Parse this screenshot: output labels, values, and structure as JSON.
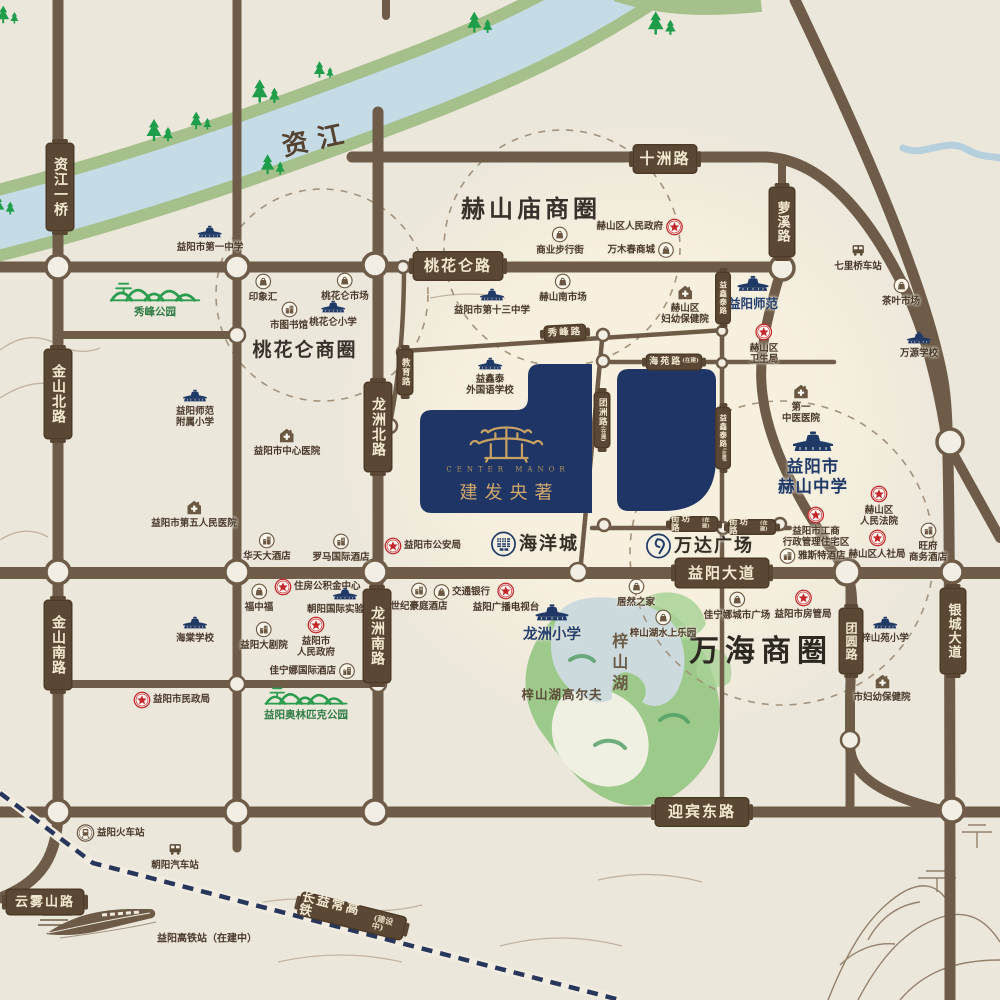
{
  "map": {
    "river_name": "资江",
    "project": {
      "name_cn": "建发央著",
      "name_en": "CENTER MANOR",
      "seal_char": "建"
    },
    "colors": {
      "paper": "#ece7db",
      "road": "#6e5c49",
      "plaque": "#5b4834",
      "navy": "#203a68",
      "gold": "#c9a264",
      "red": "#c3272b",
      "green": "#2a9d4e",
      "bank": "#a6c08c",
      "water": "#c5dbe6",
      "lake": "#ccdadd"
    },
    "business_circles": [
      {
        "id": "taohualun-circle",
        "x": 322,
        "y": 295,
        "r": 106
      },
      {
        "id": "heshanmiao-circle",
        "x": 562,
        "y": 248,
        "r": 118
      },
      {
        "id": "wanhai-circle",
        "x": 782,
        "y": 553,
        "r": 152
      }
    ],
    "free_texts": [
      {
        "id": "zijiang-river-name",
        "text": "资江",
        "x": 318,
        "y": 141,
        "size": 26,
        "color": "#54412f",
        "rot": -12,
        "ls": 10
      },
      {
        "id": "heshanmiao-circle-name",
        "text": "赫山庙商圈",
        "x": 531,
        "y": 209,
        "size": 24,
        "color": "#38302a",
        "ls": 4
      },
      {
        "id": "taohualun-circle-name",
        "text": "桃花仑商圈",
        "x": 305,
        "y": 351,
        "size": 19,
        "color": "#38302a",
        "ls": 2
      },
      {
        "id": "wanhai-circle-name",
        "text": "万海商圈",
        "x": 761,
        "y": 652,
        "size": 30,
        "color": "#2e2823",
        "ls": 6
      },
      {
        "id": "zishan-lake-name",
        "text": "梓山湖",
        "x": 618,
        "y": 664,
        "size": 16,
        "color": "#6b5a44",
        "vert": true,
        "ls": 5
      },
      {
        "id": "zishanhu-golf",
        "text": "梓山湖高尔夫",
        "x": 562,
        "y": 695,
        "size": 12.5,
        "color": "#5d4c39",
        "ls": 1
      },
      {
        "id": "hsr-station-note",
        "text": "益阳高铁站（在建中）",
        "x": 207,
        "y": 939,
        "size": 10,
        "color": "#4a392a",
        "ls": 0
      }
    ],
    "road_labels": [
      {
        "id": "shizhou-road",
        "label": "十洲路",
        "x": 665,
        "y": 159,
        "o": "h",
        "w": 62,
        "h": 27,
        "fs": 15
      },
      {
        "id": "taohualun-road",
        "label": "桃花仑路",
        "x": 458,
        "y": 266,
        "o": "h",
        "w": 88,
        "h": 27,
        "fs": 15
      },
      {
        "id": "yiyang-avenue",
        "label": "益阳大道",
        "x": 722,
        "y": 573,
        "o": "h",
        "w": 92,
        "h": 28,
        "fs": 15
      },
      {
        "id": "yingbin-east-road",
        "label": "迎宾东路",
        "x": 702,
        "y": 812,
        "o": "h",
        "w": 92,
        "h": 27,
        "fs": 15
      },
      {
        "id": "yunwushan-road",
        "label": "云雾山路",
        "x": 45,
        "y": 902,
        "o": "h",
        "w": 76,
        "h": 24,
        "fs": 13
      },
      {
        "id": "xiufeng-road",
        "label": "秀峰路",
        "x": 565,
        "y": 333,
        "o": "h",
        "w": 40,
        "h": 14,
        "fs": 9.5,
        "rot": -3
      },
      {
        "id": "haiyuan-road",
        "label": "海苑路",
        "sub": "(在建)",
        "x": 674,
        "y": 362,
        "o": "h",
        "w": 54,
        "h": 14,
        "fs": 9
      },
      {
        "id": "jiefang-road-w",
        "label": "街坊路",
        "sub": "(在建)",
        "x": 694,
        "y": 524,
        "o": "h",
        "w": 46,
        "h": 13,
        "fs": 8.5
      },
      {
        "id": "jiefang-road-e",
        "label": "街坊路",
        "sub": "(在建)",
        "x": 752,
        "y": 527,
        "o": "h",
        "w": 46,
        "h": 13,
        "fs": 8.5
      },
      {
        "id": "changyichang-hsr",
        "label": "长益常高铁",
        "sub": "(建设中)",
        "x": 352,
        "y": 916,
        "o": "h",
        "w": 106,
        "h": 22,
        "fs": 13,
        "rot": 14
      },
      {
        "id": "zijiang-bridge",
        "label": "资江一桥",
        "x": 60,
        "y": 187,
        "o": "v",
        "w": 26,
        "h": 86,
        "fs": 14
      },
      {
        "id": "jinshan-north-road",
        "label": "金山北路",
        "x": 58,
        "y": 394,
        "o": "v",
        "w": 26,
        "h": 88,
        "fs": 14
      },
      {
        "id": "jinshan-south-road",
        "label": "金山南路",
        "x": 58,
        "y": 645,
        "o": "v",
        "w": 26,
        "h": 88,
        "fs": 14
      },
      {
        "id": "longzhou-north-road",
        "label": "龙洲北路",
        "x": 378,
        "y": 427,
        "o": "v",
        "w": 26,
        "h": 88,
        "fs": 14
      },
      {
        "id": "longzhou-south-road",
        "label": "龙洲南路",
        "x": 377,
        "y": 636,
        "o": "v",
        "w": 26,
        "h": 92,
        "fs": 14
      },
      {
        "id": "luoxi-road",
        "label": "萝溪路",
        "x": 782,
        "y": 222,
        "o": "v",
        "w": 24,
        "h": 68,
        "fs": 13
      },
      {
        "id": "tuanyuan-road",
        "label": "团圆路",
        "x": 851,
        "y": 641,
        "o": "v",
        "w": 22,
        "h": 64,
        "fs": 12
      },
      {
        "id": "yincheng-avenue",
        "label": "银城大道",
        "x": 953,
        "y": 631,
        "o": "v",
        "w": 24,
        "h": 84,
        "fs": 13
      },
      {
        "id": "jiaoyu-road",
        "label": "教育路",
        "x": 405,
        "y": 372,
        "o": "v",
        "w": 14,
        "h": 44,
        "fs": 8.5
      },
      {
        "id": "tuanzhou-road",
        "label": "团洲路",
        "sub": "(在建)",
        "x": 602,
        "y": 420,
        "o": "v",
        "w": 14,
        "h": 54,
        "fs": 8.5
      },
      {
        "id": "yixintai-road-n",
        "label": "益鑫泰路",
        "x": 723,
        "y": 298,
        "o": "v",
        "w": 13,
        "h": 50,
        "fs": 7.5
      },
      {
        "id": "yixintai-road-s",
        "label": "益鑫泰路",
        "sub": "(在建)",
        "x": 723,
        "y": 438,
        "o": "v",
        "w": 13,
        "h": 60,
        "fs": 7.5
      }
    ],
    "pois": [
      {
        "id": "yiyang-no1-middle-school",
        "icon": "school",
        "label": "益阳市第一中学",
        "x": 210,
        "y": 236,
        "lp": "b"
      },
      {
        "id": "yinxianghui-mall",
        "icon": "bag",
        "label": "印象汇",
        "x": 263,
        "y": 285,
        "lp": "b"
      },
      {
        "id": "taohualun-market",
        "icon": "bag",
        "label": "桃花仑市场",
        "x": 345,
        "y": 284,
        "lp": "b"
      },
      {
        "id": "city-library",
        "icon": "hotel",
        "label": "市图书馆",
        "x": 289,
        "y": 313,
        "lp": "b"
      },
      {
        "id": "taohualun-primary",
        "icon": "school",
        "label": "桃花仑小学",
        "x": 333,
        "y": 311,
        "lp": "b"
      },
      {
        "id": "shangye-buxingjie",
        "icon": "bag",
        "label": "商业步行街",
        "x": 560,
        "y": 238,
        "lp": "b"
      },
      {
        "id": "heshan-district-gov",
        "icon": "star",
        "label": "赫山区人民政府",
        "x": 673,
        "y": 227,
        "lp": "l"
      },
      {
        "id": "wanmuchun-mall",
        "icon": "bag",
        "label": "万木春商城",
        "x": 664,
        "y": 250,
        "lp": "l"
      },
      {
        "id": "heshan-south-market",
        "icon": "bag",
        "label": "赫山南市场",
        "x": 563,
        "y": 285,
        "lp": "b"
      },
      {
        "id": "yiyang-no13-middle-school",
        "icon": "school",
        "label": "益阳市第十三中学",
        "x": 492,
        "y": 299,
        "lp": "b"
      },
      {
        "id": "heshan-fuyou-hospital",
        "icon": "hospital",
        "label": "赫山区\n妇幼保健院",
        "x": 685,
        "y": 296,
        "lp": "b"
      },
      {
        "id": "qiliqiao-station",
        "icon": "bus",
        "label": "七里桥车站",
        "x": 858,
        "y": 253,
        "lp": "b"
      },
      {
        "id": "tea-market",
        "icon": "bag",
        "label": "茶叶市场",
        "x": 901,
        "y": 289,
        "lp": "b"
      },
      {
        "id": "wanyuan-school",
        "icon": "school",
        "label": "万源学校",
        "x": 919,
        "y": 342,
        "lp": "b"
      },
      {
        "id": "yiyang-shifan",
        "icon": "school",
        "label": "益阳师范",
        "x": 753,
        "y": 286,
        "lp": "b",
        "cls": "c-nav12",
        "iw": 34,
        "ih": 20
      },
      {
        "id": "heshan-health-bureau",
        "icon": "star",
        "label": "赫山区\n卫生局",
        "x": 764,
        "y": 335,
        "lp": "b"
      },
      {
        "id": "xiufeng-park",
        "icon": "ridge",
        "label": "秀峰公园",
        "x": 155,
        "y": 292,
        "lp": "b",
        "cls": "c-green",
        "iw": 95,
        "ih": 24
      },
      {
        "id": "shifan-fushu-primary",
        "icon": "school",
        "label": "益阳师范\n附属小学",
        "x": 195,
        "y": 400,
        "lp": "b"
      },
      {
        "id": "yiyang-center-hospital",
        "icon": "hospital",
        "label": "益阳市中心医院",
        "x": 287,
        "y": 439,
        "lp": "b"
      },
      {
        "id": "yiyang-no5-hospital",
        "icon": "hospital",
        "label": "益阳市第五人民医院",
        "x": 194,
        "y": 511,
        "lp": "b"
      },
      {
        "id": "yixintai-foreign-school",
        "icon": "school",
        "label": "益鑫泰\n外国语学校",
        "x": 490,
        "y": 368,
        "lp": "b"
      },
      {
        "id": "public-security-bureau",
        "icon": "star",
        "label": "益阳市公安局",
        "x": 394,
        "y": 546,
        "lp": "r"
      },
      {
        "id": "ocean-city",
        "icon": "ocean",
        "label": "海洋城",
        "x": 500,
        "y": 544,
        "lp": "r",
        "cls": "c-xl"
      },
      {
        "id": "wanda-plaza",
        "icon": "wanda",
        "label": "万达广场",
        "x": 655,
        "y": 546,
        "lp": "r",
        "cls": "c-xl"
      },
      {
        "id": "no1-tcm-hospital",
        "icon": "hospital",
        "label": "第一\n中医医院",
        "x": 801,
        "y": 395,
        "lp": "b"
      },
      {
        "id": "heshan-middle-school",
        "icon": "school",
        "label": "益阳市\n赫山中学",
        "x": 813,
        "y": 441,
        "lp": "b",
        "cls": "c-nav16",
        "iw": 46,
        "ih": 26
      },
      {
        "id": "heshan-court",
        "icon": "star",
        "label": "赫山区\n人民法院",
        "x": 879,
        "y": 497,
        "lp": "b"
      },
      {
        "id": "gongshang-admin",
        "icon": "star",
        "label": "益阳市工商\n行政管理住宅区",
        "x": 816,
        "y": 518,
        "lp": "b"
      },
      {
        "id": "yasite-hotel",
        "icon": "hotel",
        "label": "雅斯特酒店",
        "x": 789,
        "y": 556,
        "lp": "r"
      },
      {
        "id": "heshan-renshe-bureau",
        "icon": "star",
        "label": "赫山区人社局",
        "x": 877,
        "y": 541,
        "lp": "b"
      },
      {
        "id": "wangfu-hotel",
        "icon": "hotel",
        "label": "旺府\n商务酒店",
        "x": 928,
        "y": 534,
        "lp": "b"
      },
      {
        "id": "huatian-hotel",
        "icon": "hotel",
        "label": "华天大酒店",
        "x": 267,
        "y": 544,
        "lp": "b"
      },
      {
        "id": "roman-intl-hotel",
        "icon": "hotel",
        "label": "罗马国际酒店",
        "x": 341,
        "y": 545,
        "lp": "b"
      },
      {
        "id": "housing-fund-center",
        "icon": "star",
        "label": "住房公积金中心",
        "x": 284,
        "y": 587,
        "lp": "r"
      },
      {
        "id": "fuzhongfu",
        "icon": "bag",
        "label": "福中福",
        "x": 259,
        "y": 595,
        "lp": "b"
      },
      {
        "id": "chaoyang-intl-school",
        "icon": "school",
        "label": "朝阳国际实验学校",
        "x": 345,
        "y": 598,
        "lp": "b"
      },
      {
        "id": "yiyang-grand-theatre",
        "icon": "hotel",
        "label": "益阳大剧院",
        "x": 264,
        "y": 633,
        "lp": "b"
      },
      {
        "id": "yiyang-city-gov",
        "icon": "star",
        "label": "益阳市\n人民政府",
        "x": 316,
        "y": 628,
        "lp": "b"
      },
      {
        "id": "jianingna-intl-hotel",
        "icon": "hotel",
        "label": "佳宁娜国际酒店",
        "x": 345,
        "y": 671,
        "lp": "l"
      },
      {
        "id": "shiji-haoting-hotel",
        "icon": "hotel",
        "label": "世纪豪庭酒店",
        "x": 419,
        "y": 594,
        "lp": "b"
      },
      {
        "id": "bank-of-communications",
        "icon": "bag",
        "label": "交通银行",
        "x": 443,
        "y": 592,
        "lp": "r"
      },
      {
        "id": "yiyang-radio-tv",
        "icon": "star",
        "label": "益阳广播电视台",
        "x": 506,
        "y": 594,
        "lp": "b"
      },
      {
        "id": "longzhou-primary",
        "icon": "school",
        "label": "龙洲小学",
        "x": 552,
        "y": 614,
        "lp": "b",
        "cls": "c-nav14",
        "iw": 36,
        "ih": 22
      },
      {
        "id": "juran-home",
        "icon": "bag",
        "label": "居然之家",
        "x": 636,
        "y": 590,
        "lp": "b"
      },
      {
        "id": "zishanhu-waterpark",
        "icon": "bag",
        "label": "梓山湖水上乐园",
        "x": 663,
        "y": 621,
        "lp": "b"
      },
      {
        "id": "haitang-school",
        "icon": "school",
        "label": "海棠学校",
        "x": 195,
        "y": 627,
        "lp": "b"
      },
      {
        "id": "civil-affairs-bureau",
        "icon": "star",
        "label": "益阳市民政局",
        "x": 143,
        "y": 700,
        "lp": "r"
      },
      {
        "id": "yiyang-olympic-park",
        "icon": "ridge",
        "label": "益阳奥林匹克公园",
        "x": 306,
        "y": 697,
        "lp": "b",
        "cls": "c-green",
        "iw": 100,
        "ih": 22
      },
      {
        "id": "jianingna-city-plaza",
        "icon": "bag",
        "label": "佳宁娜城市广场",
        "x": 737,
        "y": 603,
        "lp": "b"
      },
      {
        "id": "housing-admin-bureau",
        "icon": "star",
        "label": "益阳市房管局",
        "x": 803,
        "y": 601,
        "lp": "b"
      },
      {
        "id": "zishanyuan-primary",
        "icon": "school",
        "label": "梓山苑小学",
        "x": 885,
        "y": 627,
        "lp": "b"
      },
      {
        "id": "city-fuyou-hospital",
        "icon": "hospital",
        "label": "市妇幼保健院",
        "x": 882,
        "y": 685,
        "lp": "b"
      },
      {
        "id": "yiyang-railway-station",
        "icon": "trainstation",
        "label": "益阳火车站",
        "x": 86,
        "y": 833,
        "lp": "r"
      },
      {
        "id": "chaoyang-bus-station",
        "icon": "bus",
        "label": "朝阳汽车站",
        "x": 175,
        "y": 852,
        "lp": "b"
      }
    ],
    "trees": [
      [
        8,
        16,
        0.8
      ],
      [
        3,
        206,
        0.9
      ],
      [
        160,
        132,
        1
      ],
      [
        201,
        122,
        0.8
      ],
      [
        266,
        93,
        1.05
      ],
      [
        273,
        166,
        0.9
      ],
      [
        324,
        71,
        0.75
      ],
      [
        480,
        24,
        0.95
      ],
      [
        662,
        25,
        1.05
      ]
    ],
    "junctions": [
      [
        58,
        267,
        12
      ],
      [
        237,
        267,
        12
      ],
      [
        375,
        265,
        12
      ],
      [
        782,
        268,
        12
      ],
      [
        237,
        335,
        8
      ],
      [
        403,
        267,
        6
      ],
      [
        403,
        352,
        6
      ],
      [
        390,
        426,
        7
      ],
      [
        603,
        335,
        6
      ],
      [
        603,
        361,
        6
      ],
      [
        722,
        331,
        5
      ],
      [
        722,
        363,
        5
      ],
      [
        604,
        525,
        6
      ],
      [
        723,
        528,
        6
      ],
      [
        780,
        524,
        6
      ],
      [
        58,
        572,
        12
      ],
      [
        237,
        572,
        12
      ],
      [
        375,
        572,
        12
      ],
      [
        578,
        572,
        9
      ],
      [
        847,
        572,
        13
      ],
      [
        952,
        572,
        11
      ],
      [
        237,
        684,
        8
      ],
      [
        378,
        684,
        8
      ],
      [
        850,
        740,
        9
      ],
      [
        950,
        442,
        13
      ],
      [
        58,
        812,
        12
      ],
      [
        237,
        812,
        12
      ],
      [
        375,
        812,
        12
      ],
      [
        722,
        812,
        10
      ],
      [
        952,
        810,
        12
      ]
    ]
  }
}
